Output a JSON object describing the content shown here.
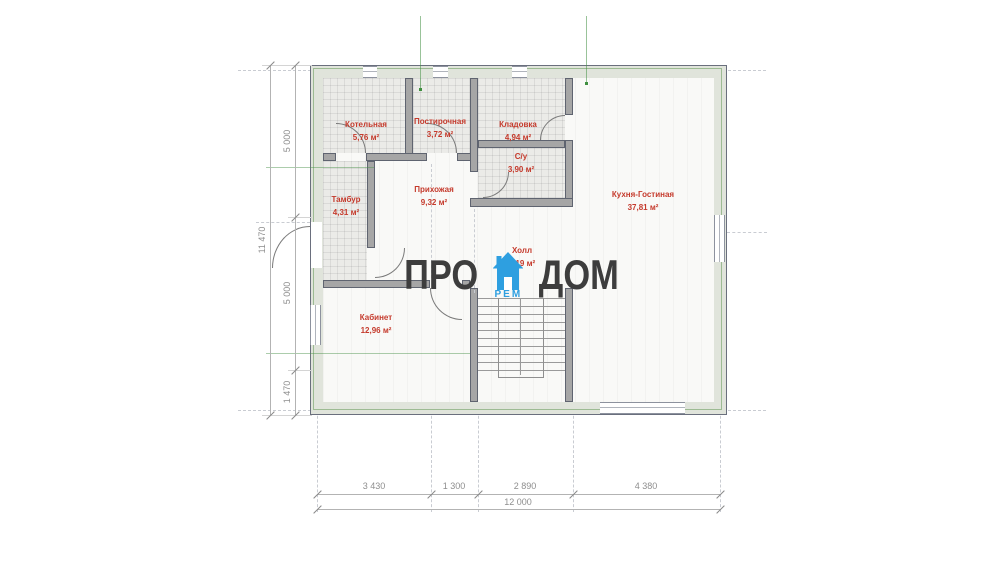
{
  "watermark": {
    "left": "ПРО",
    "right": "ДОМ",
    "sub": "РЕМ"
  },
  "rooms": [
    {
      "name": "Котельная",
      "area": "5,76 м²"
    },
    {
      "name": "Постирочная",
      "area": "3,72 м²"
    },
    {
      "name": "Кладовка",
      "area": "4,94 м²"
    },
    {
      "name": "С/у",
      "area": "3,90 м²"
    },
    {
      "name": "Тамбур",
      "area": "4,31 м²"
    },
    {
      "name": "Прихожая",
      "area": "9,32 м²"
    },
    {
      "name": "Кухня-Гостиная",
      "area": "37,81 м²"
    },
    {
      "name": "Холл",
      "area": "7,19 м²"
    },
    {
      "name": "Кабинет",
      "area": "12,96 м²"
    }
  ],
  "dimensions": {
    "left_total": "11 470",
    "left_segments": [
      "5 000",
      "5 000",
      "1 470"
    ],
    "bottom_segments": [
      "3 430",
      "1 300",
      "2 890",
      "4 380"
    ],
    "bottom_total": "12 000"
  },
  "colors": {
    "accent_blue": "#2E9FE0",
    "room_label_red": "#C53A2C",
    "wall_gray": "#A6A6A6",
    "dimension_gray": "#8E8E8E"
  }
}
